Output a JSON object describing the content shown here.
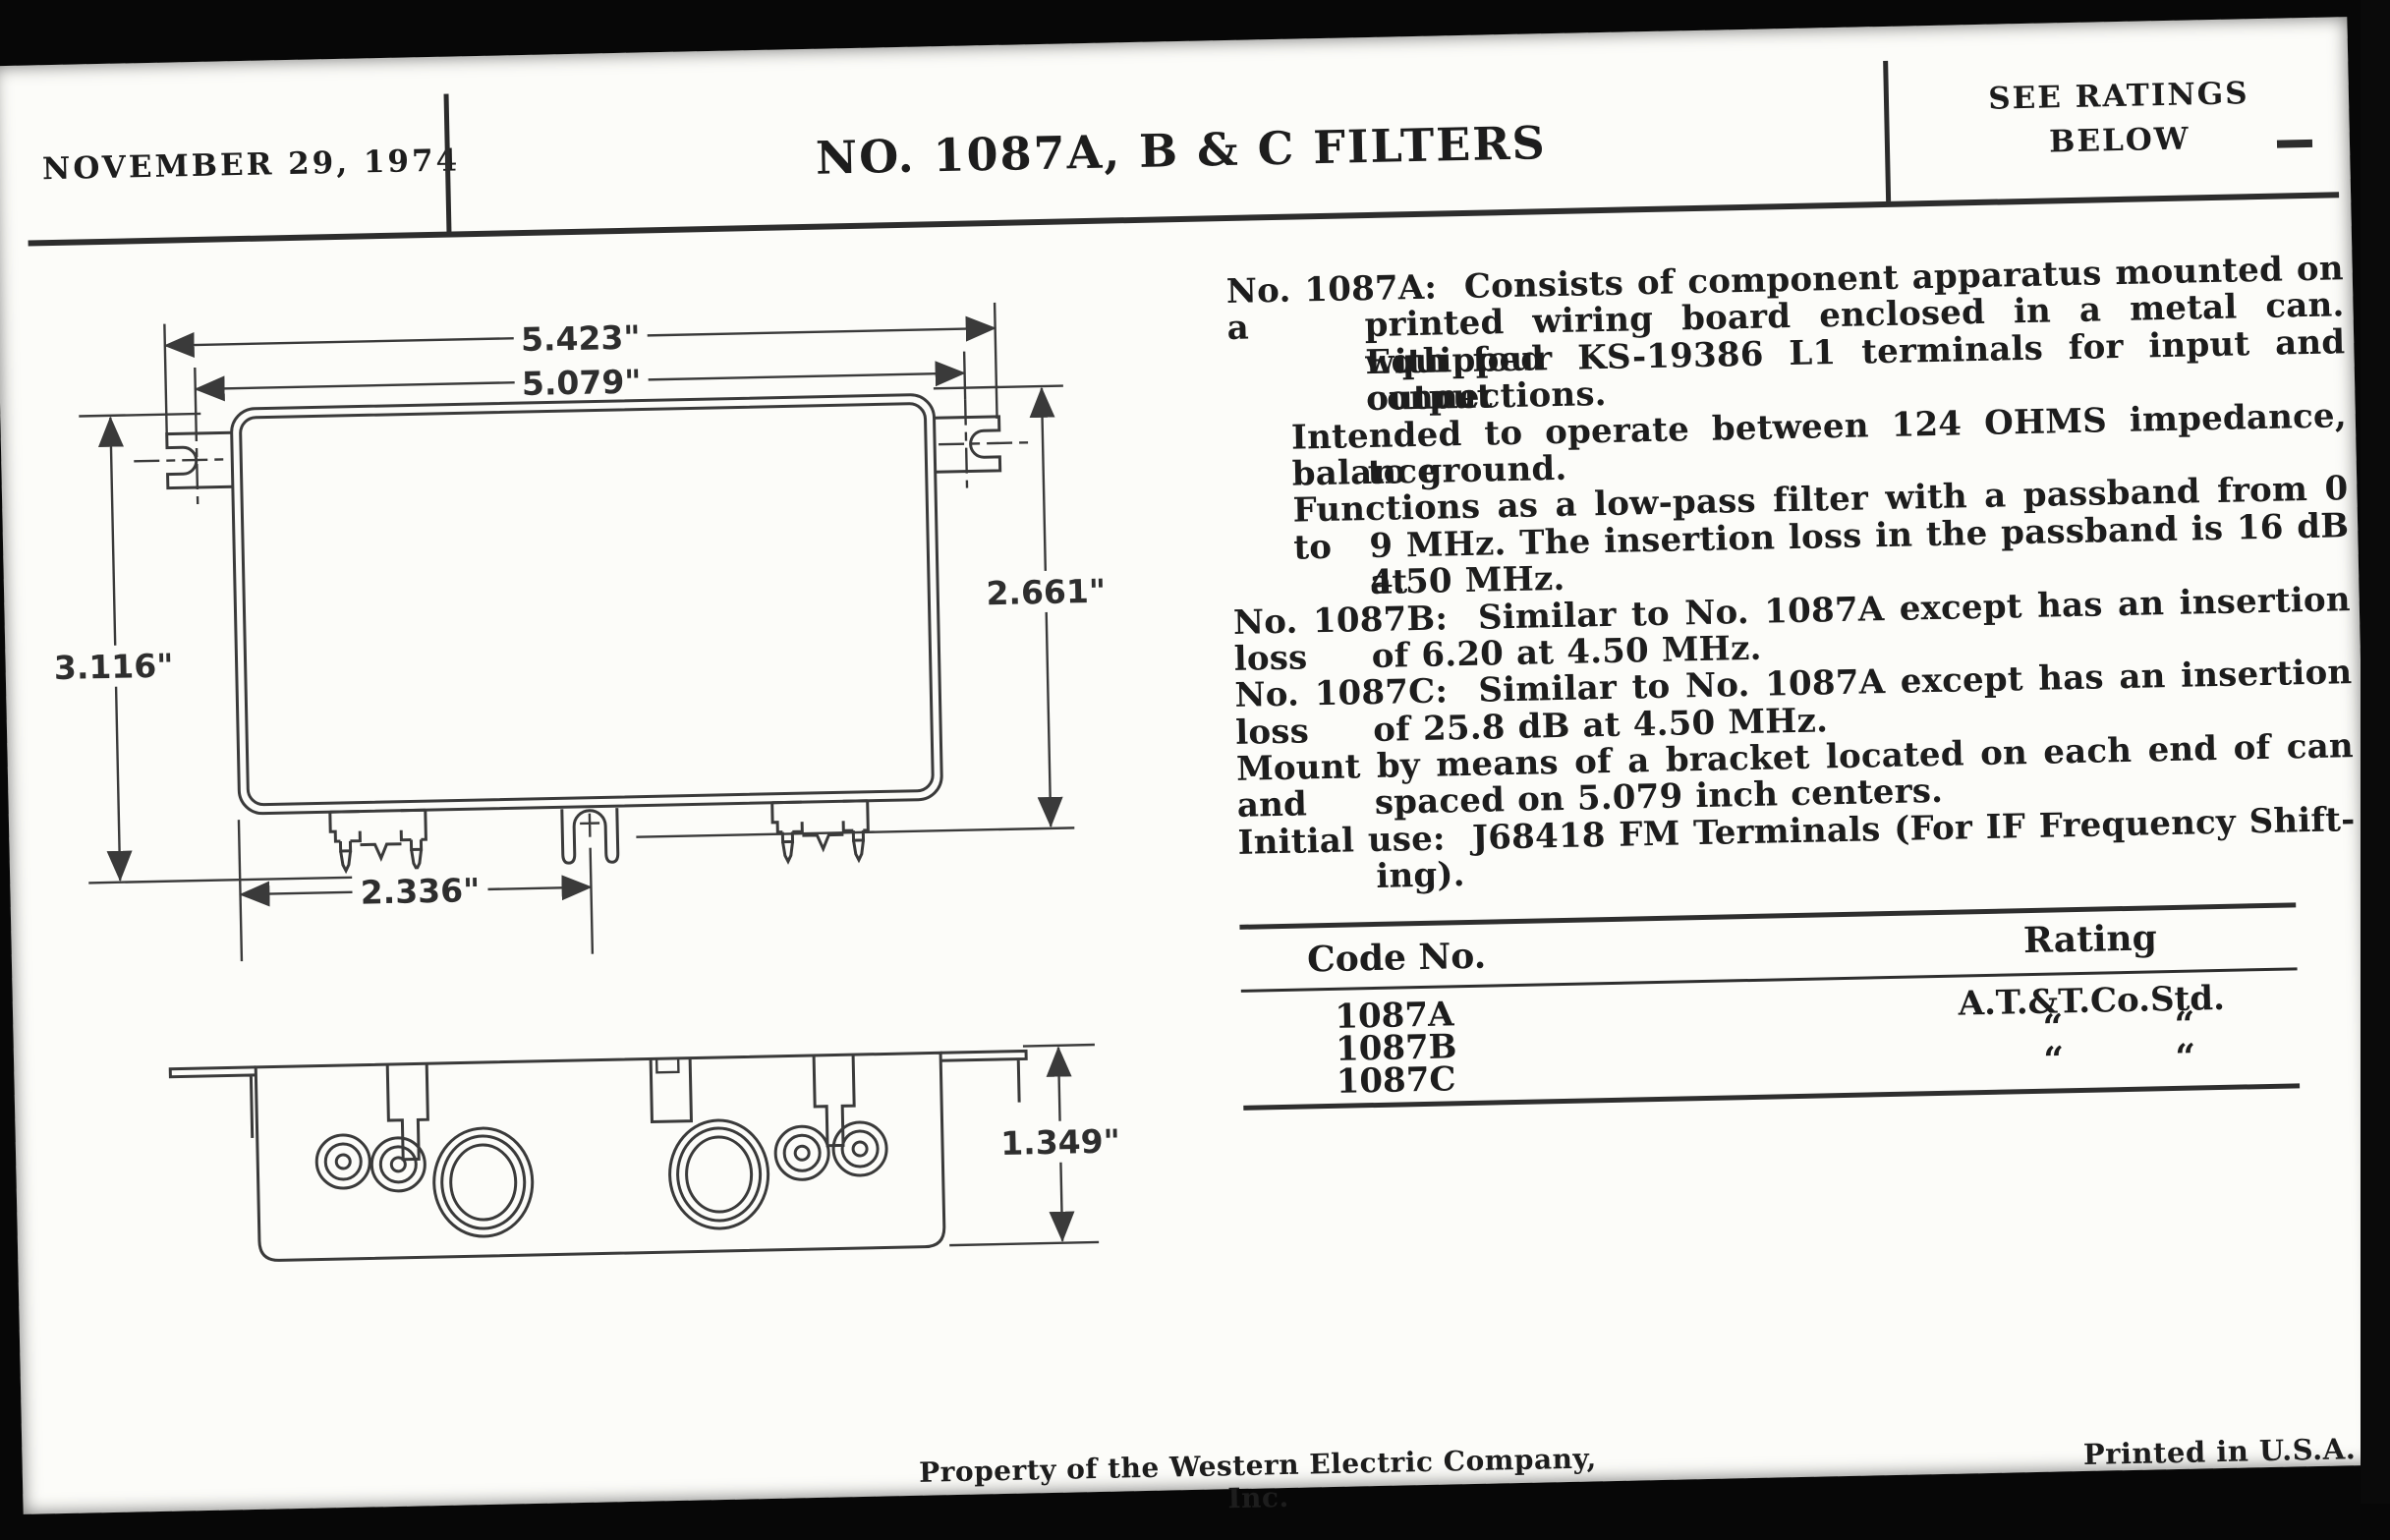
{
  "colors": {
    "paper": "#fcfcf9",
    "ink": "#1d1d1d",
    "line": "#3a3a3a",
    "scan_edge": "#0a0a0a"
  },
  "header": {
    "date": "NOVEMBER 29, 1974",
    "title": "NO. 1087A, B & C FILTERS",
    "ratings_note": [
      "SEE RATINGS",
      "BELOW"
    ]
  },
  "drawing_labels": {
    "top_view": {
      "width_outer": "5.423\"",
      "width_centers": "5.079\"",
      "height_left": "3.116\"",
      "height_right": "2.661\"",
      "terminal_spacing": "2.336\""
    },
    "side_view": {
      "height": "1.349\""
    }
  },
  "spec": {
    "lines": [
      {
        "indent": "none",
        "justify": true,
        "text": "No. 1087A:  Consists of component apparatus mounted on a"
      },
      {
        "indent": "hang",
        "justify": true,
        "text": "printed wiring board enclosed in a metal can. Equipped"
      },
      {
        "indent": "hang",
        "justify": true,
        "text": "with four KS-19386 L1 terminals for input and output"
      },
      {
        "indent": "hang",
        "justify": false,
        "text": "connections."
      },
      {
        "indent": "sub",
        "justify": true,
        "text": "Intended to operate between 124 OHMS impedance, balance"
      },
      {
        "indent": "hang",
        "justify": false,
        "text": "to ground."
      },
      {
        "indent": "sub",
        "justify": true,
        "text": "Functions as a low-pass filter with a passband from 0 to"
      },
      {
        "indent": "hang",
        "justify": true,
        "text": "9 MHz. The insertion loss in the passband is 16 dB at"
      },
      {
        "indent": "hang",
        "justify": false,
        "text": "4.50 MHz."
      },
      {
        "indent": "none",
        "justify": true,
        "text": "No. 1087B:  Similar to No. 1087A except has an insertion loss"
      },
      {
        "indent": "hang",
        "justify": false,
        "text": "of 6.20 at 4.50 MHz."
      },
      {
        "indent": "none",
        "justify": true,
        "text": "No. 1087C:  Similar to No. 1087A except has an insertion loss"
      },
      {
        "indent": "hang",
        "justify": false,
        "text": "of 25.8 dB at 4.50 MHz."
      },
      {
        "indent": "none",
        "justify": true,
        "text": "Mount by means of a bracket located on each end of can and"
      },
      {
        "indent": "hang",
        "justify": false,
        "text": "spaced on 5.079 inch centers."
      },
      {
        "indent": "none",
        "justify": true,
        "text": "Initial use:  J68418 FM Terminals (For IF Frequency Shift-"
      },
      {
        "indent": "hang",
        "justify": false,
        "text": "ing)."
      }
    ]
  },
  "table": {
    "col_code": "Code No.",
    "col_rating": "Rating",
    "ditto_mark": "“",
    "rows": [
      {
        "code": "1087A",
        "rating": "A.T.&T.Co.Std.",
        "ditto": false
      },
      {
        "code": "1087B",
        "rating": "",
        "ditto": true
      },
      {
        "code": "1087C",
        "rating": "",
        "ditto": true
      }
    ]
  },
  "footer": {
    "property_note": "Property of the Western Electric Company, Inc.",
    "printed_note": "Printed in U.S.A."
  }
}
